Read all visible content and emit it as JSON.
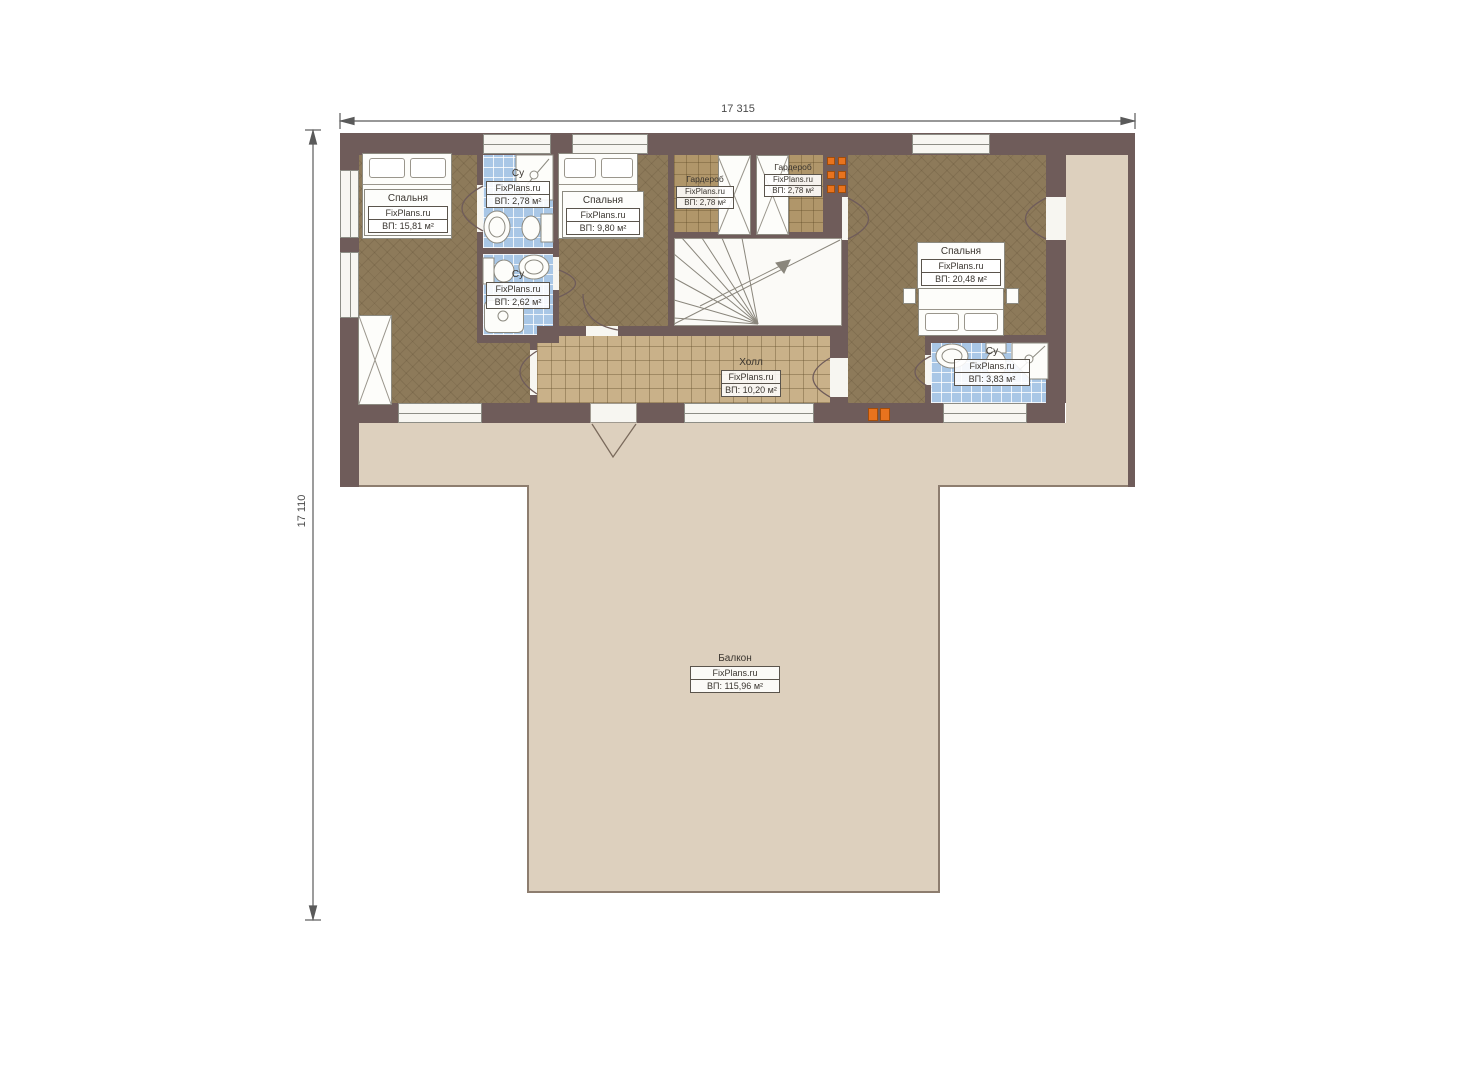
{
  "page": {
    "background": "#ffffff",
    "type": "floor-plan-drawing"
  },
  "dimensions": {
    "width_label": "17 315",
    "height_label": "17 110"
  },
  "brand": "FixPlans.ru",
  "rooms": [
    {
      "id": "bedroom-left",
      "name": "Спальня",
      "brand": "FixPlans.ru",
      "area": "ВП: 15,81 м²"
    },
    {
      "id": "bathroom-top",
      "name": "Су",
      "brand": "FixPlans.ru",
      "area": "ВП: 2,78 м²"
    },
    {
      "id": "bathroom-middle",
      "name": "Су",
      "brand": "FixPlans.ru",
      "area": "ВП: 2,62 м²"
    },
    {
      "id": "bedroom-middle",
      "name": "Спальня",
      "brand": "FixPlans.ru",
      "area": "ВП: 9,80 м²"
    },
    {
      "id": "wardrobe-left",
      "name": "Гардероб",
      "brand": "FixPlans.ru",
      "area": "ВП: 2,78 м²"
    },
    {
      "id": "wardrobe-right",
      "name": "Гардероб",
      "brand": "FixPlans.ru",
      "area": "ВП: 2,78 м²"
    },
    {
      "id": "hall",
      "name": "Холл",
      "brand": "FixPlans.ru",
      "area": "ВП: 10,20 м²"
    },
    {
      "id": "bedroom-right",
      "name": "Спальня",
      "brand": "FixPlans.ru",
      "area": "ВП: 20,48 м²"
    },
    {
      "id": "bathroom-right",
      "name": "Су",
      "brand": "FixPlans.ru",
      "area": "ВП: 3,83 м²"
    },
    {
      "id": "balcony",
      "name": "Балкон",
      "brand": "FixPlans.ru",
      "area": "ВП: 115,96 м²"
    }
  ],
  "colors": {
    "wall": "#6f5c5a",
    "bedroom_floor": "#8d7a5a",
    "wardrobe_floor": "#b0966a",
    "hall_floor": "#c9b189",
    "bathroom_floor": "#a9c7e6",
    "balcony": "#ddd0be",
    "accent_orange": "#e8731e"
  }
}
